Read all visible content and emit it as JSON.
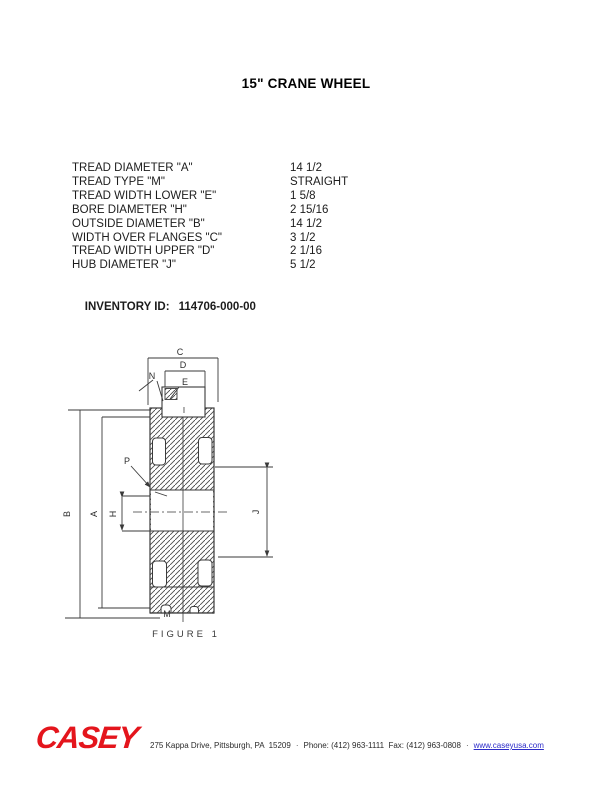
{
  "page": {
    "title": "15\" CRANE WHEEL"
  },
  "specs": {
    "rows": [
      {
        "label": "TREAD DIAMETER \"A\"",
        "value": "14 1/2"
      },
      {
        "label": "TREAD TYPE \"M\"",
        "value": "STRAIGHT"
      },
      {
        "label": "TREAD WIDTH LOWER \"E\"",
        "value": "1 5/8"
      },
      {
        "label": "BORE DIAMETER \"H\"",
        "value": "2 15/16"
      },
      {
        "label": "OUTSIDE DIAMETER \"B\"",
        "value": "14 1/2"
      },
      {
        "label": "WIDTH OVER FLANGES \"C\"",
        "value": "3 1/2"
      },
      {
        "label": "TREAD WIDTH UPPER \"D\"",
        "value": "2 1/16"
      },
      {
        "label": "HUB DIAMETER \"J\"",
        "value": "5 1/2"
      }
    ]
  },
  "inventory": {
    "label": "INVENTORY ID:",
    "value": "114706-000-00"
  },
  "figure": {
    "caption": "FIGURE  1",
    "labels": {
      "c": "C",
      "d": "D",
      "e": "E",
      "n": "N",
      "i": "I",
      "p": "P",
      "h": "H",
      "a": "A",
      "b": "B",
      "j": "J",
      "m": "M"
    }
  },
  "footer": {
    "logo": "CASEY",
    "address": "275 Kappa Drive, Pittsburgh, PA  15209",
    "phone": "Phone: (412) 963-1111  Fax: (412) 963-0808",
    "separator": "·",
    "website": "www.caseyusa.com",
    "colors": {
      "logo_red": "#e4151c",
      "link_blue": "#2b2bc8"
    }
  }
}
